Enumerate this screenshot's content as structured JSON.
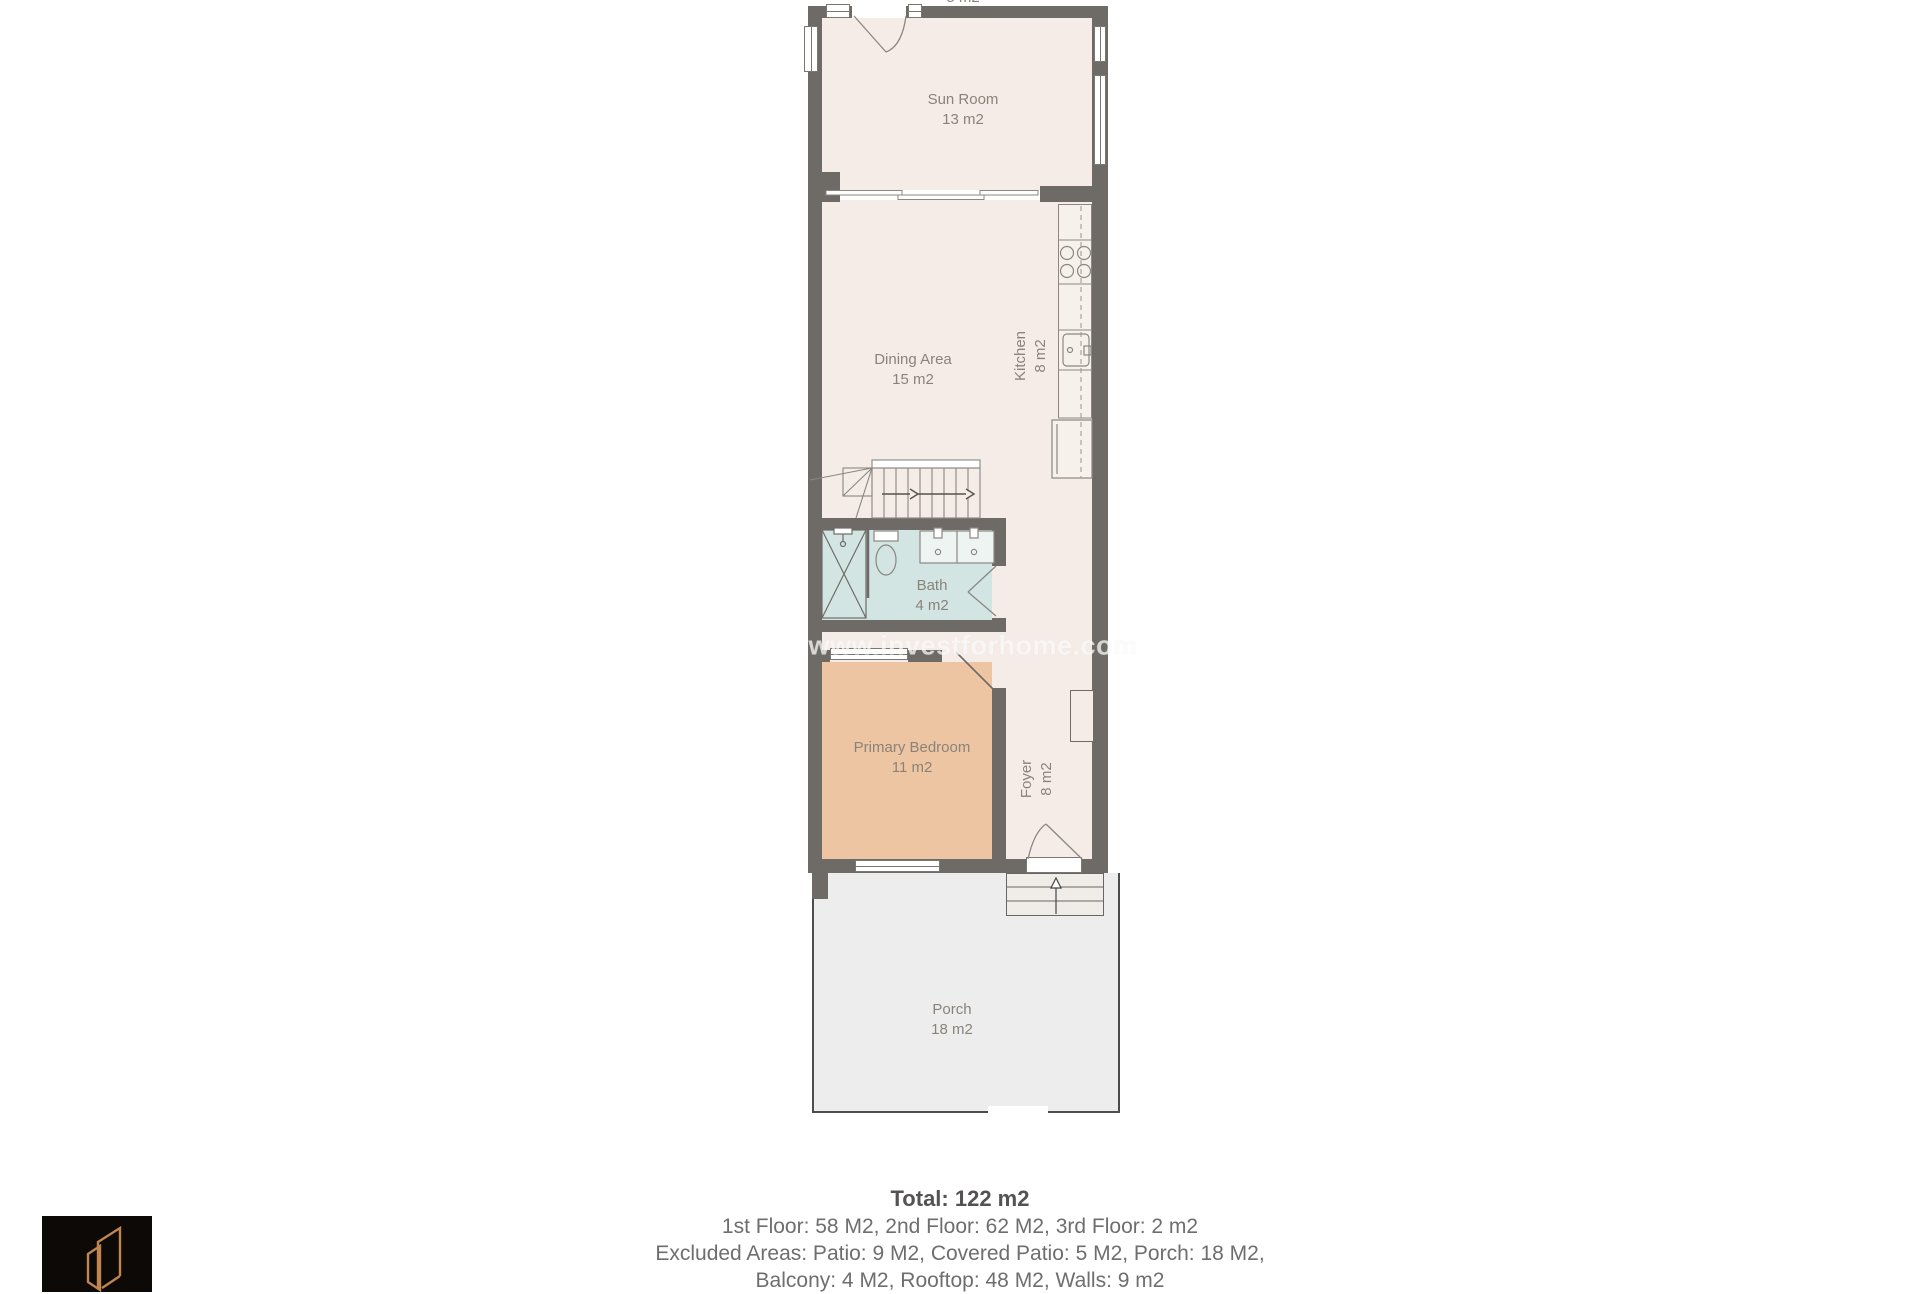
{
  "watermark": {
    "text": "www.investforhome.com"
  },
  "top_partial_label": {
    "area": "5 m2"
  },
  "rooms": {
    "sun_room": {
      "name": "Sun Room",
      "area": "13 m2"
    },
    "dining_area": {
      "name": "Dining Area",
      "area": "15 m2"
    },
    "kitchen": {
      "name": "Kitchen",
      "area": "8 m2"
    },
    "bath": {
      "name": "Bath",
      "area": "4 m2"
    },
    "primary_bedroom": {
      "name": "Primary Bedroom",
      "area": "11 m2"
    },
    "foyer": {
      "name": "Foyer",
      "area": "8 m2"
    },
    "porch": {
      "name": "Porch",
      "area": "18 m2"
    }
  },
  "summary": {
    "total": "Total: 122 m2",
    "floors": "1st Floor: 58 M2, 2nd Floor: 62 M2, 3rd Floor: 2 m2",
    "excluded": "Excluded Areas: Patio: 9 M2, Covered Patio: 5 M2, Porch: 18 M2,",
    "excluded2": "Balcony: 4 M2, Rooftop: 48 M2, Walls: 9 m2"
  },
  "colors": {
    "wall": "#6e6b67",
    "room_fill": "#f5ece7",
    "bedroom_fill": "#eec5a2",
    "bath_fill": "#d3e5e2",
    "porch_fill": "#ededed",
    "label_text": "#8a837a",
    "summary_text": "#6e6e6e",
    "logo_copper": "#c08550",
    "logo_bg": "#0c0907"
  }
}
